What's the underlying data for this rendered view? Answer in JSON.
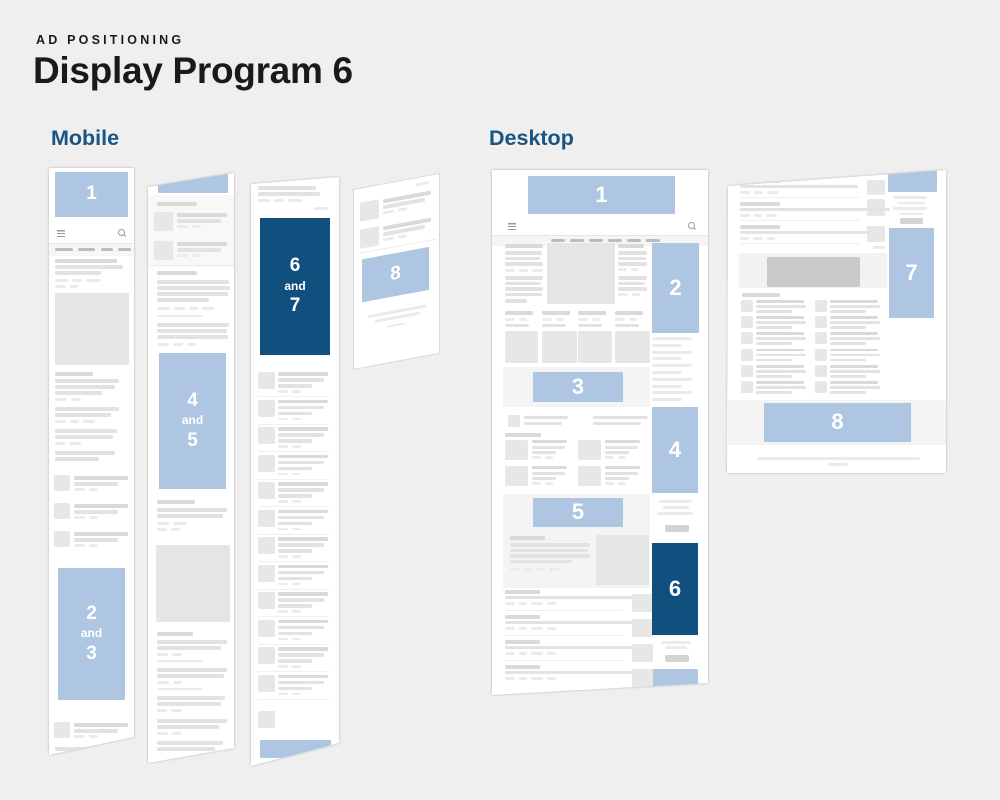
{
  "header": {
    "kicker": "AD POSITIONING",
    "title": "Display Program 6"
  },
  "sections": {
    "mobile": "Mobile",
    "desktop": "Desktop"
  },
  "ads": {
    "mobile": [
      {
        "name": "position-1",
        "label": "1",
        "variant": "light"
      },
      {
        "name": "positions-2-3",
        "lines": [
          "2",
          "and",
          "3"
        ],
        "variant": "light"
      },
      {
        "name": "positions-4-5",
        "lines": [
          "4",
          "and",
          "5"
        ],
        "variant": "light"
      },
      {
        "name": "positions-6-7",
        "lines": [
          "6",
          "and",
          "7"
        ],
        "variant": "dark"
      },
      {
        "name": "position-8",
        "label": "8",
        "variant": "light"
      }
    ],
    "desktop": [
      {
        "name": "position-1",
        "label": "1",
        "variant": "light"
      },
      {
        "name": "position-2",
        "label": "2",
        "variant": "light"
      },
      {
        "name": "position-3",
        "label": "3",
        "variant": "light"
      },
      {
        "name": "position-4",
        "label": "4",
        "variant": "light"
      },
      {
        "name": "position-5",
        "label": "5",
        "variant": "light"
      },
      {
        "name": "position-6",
        "label": "6",
        "variant": "dark"
      },
      {
        "name": "position-7",
        "label": "7",
        "variant": "light"
      },
      {
        "name": "position-8",
        "label": "8",
        "variant": "light"
      }
    ]
  },
  "colors": {
    "ad_light": "#aec6e1",
    "ad_dark": "#11507e",
    "heading_blue": "#1a5482",
    "text": "#1a1a1a",
    "background": "#efefef"
  }
}
